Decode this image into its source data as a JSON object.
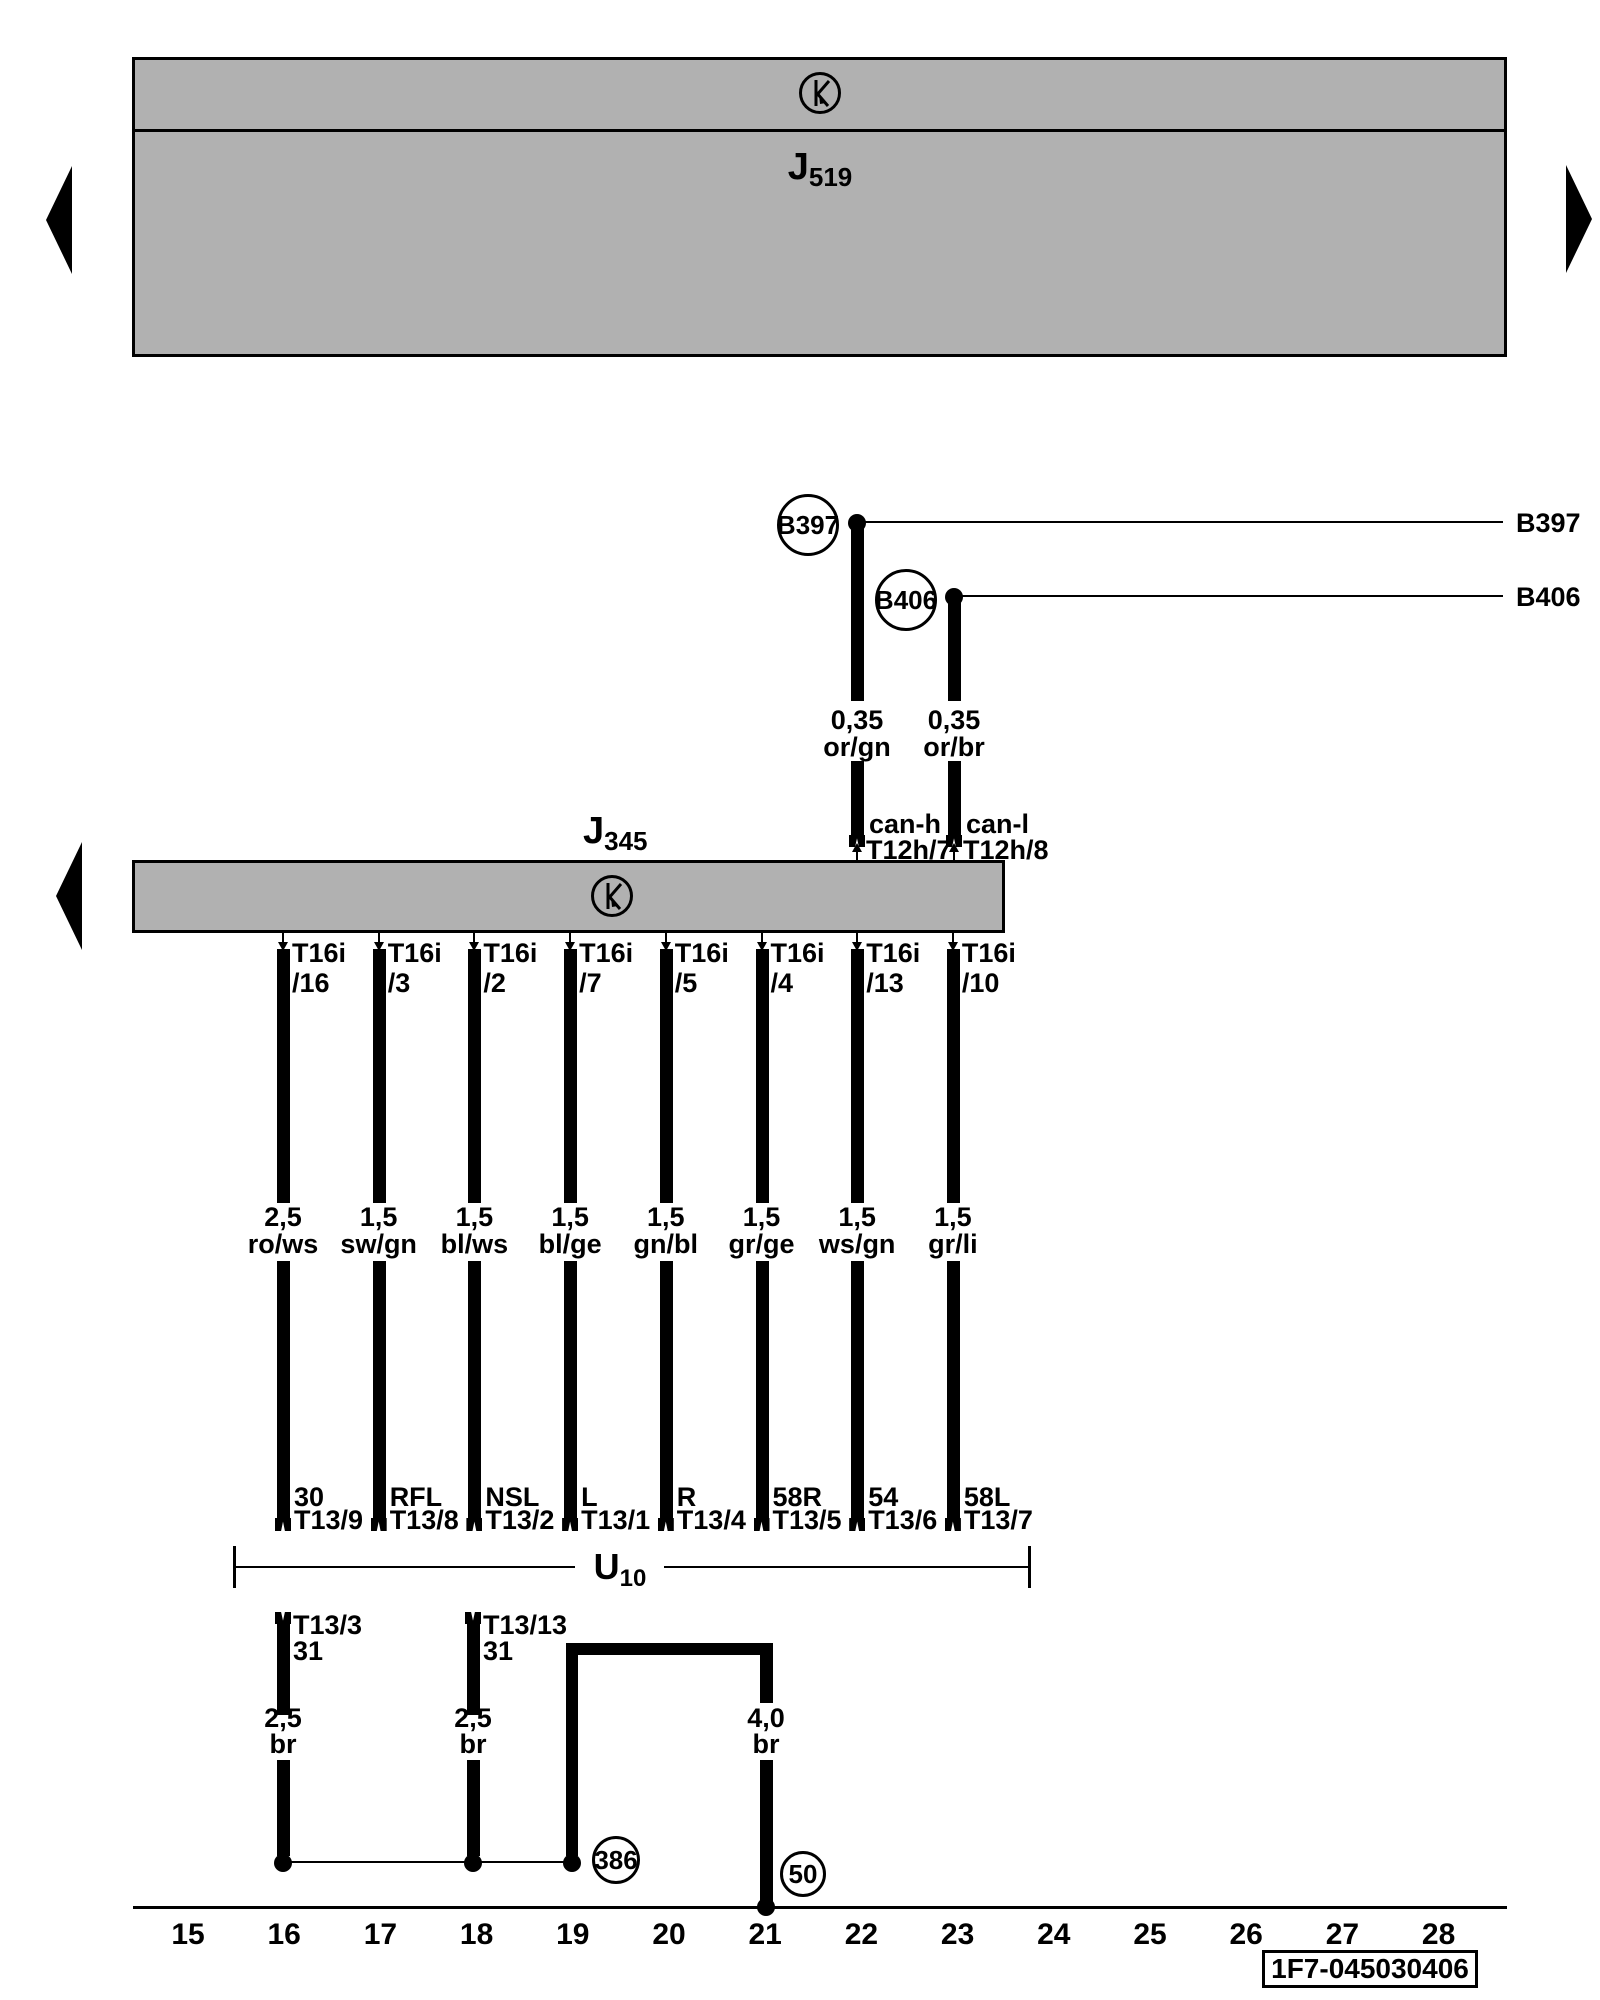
{
  "j519": {
    "main": "J",
    "sub": "519"
  },
  "j345": {
    "main": "J",
    "sub": "345"
  },
  "can_nodes": [
    {
      "id": "B397",
      "right_label": "B397",
      "gauge": "0,35",
      "color": "or/gn",
      "signal": "can-h",
      "pin": "T12h/7"
    },
    {
      "id": "B406",
      "right_label": "B406",
      "gauge": "0,35",
      "color": "or/br",
      "signal": "can-l",
      "pin": "T12h/8"
    }
  ],
  "pins": [
    {
      "connector": "T16i",
      "slot": "/16",
      "gauge": "2,5",
      "color": "ro/ws",
      "name": "30",
      "pin": "T13/9"
    },
    {
      "connector": "T16i",
      "slot": "/3",
      "gauge": "1,5",
      "color": "sw/gn",
      "name": "RFL",
      "pin": "T13/8"
    },
    {
      "connector": "T16i",
      "slot": "/2",
      "gauge": "1,5",
      "color": "bl/ws",
      "name": "NSL",
      "pin": "T13/2"
    },
    {
      "connector": "T16i",
      "slot": "/7",
      "gauge": "1,5",
      "color": "bl/ge",
      "name": "L",
      "pin": "T13/1"
    },
    {
      "connector": "T16i",
      "slot": "/5",
      "gauge": "1,5",
      "color": "gn/bl",
      "name": "R",
      "pin": "T13/4"
    },
    {
      "connector": "T16i",
      "slot": "/4",
      "gauge": "1,5",
      "color": "gr/ge",
      "name": "58R",
      "pin": "T13/5"
    },
    {
      "connector": "T16i",
      "slot": "/13",
      "gauge": "1,5",
      "color": "ws/gn",
      "name": "54",
      "pin": "T13/6"
    },
    {
      "connector": "T16i",
      "slot": "/10",
      "gauge": "1,5",
      "color": "gr/li",
      "name": "58L",
      "pin": "T13/7"
    }
  ],
  "u10": {
    "main": "U",
    "sub": "10"
  },
  "ground_pins": [
    {
      "pin": "T13/3",
      "terminal": "31",
      "gauge": "2,5",
      "color": "br"
    },
    {
      "pin": "T13/13",
      "terminal": "31",
      "gauge": "2,5",
      "color": "br"
    }
  ],
  "heavy_ground": {
    "gauge": "4,0",
    "color": "br"
  },
  "grounds": [
    {
      "id": "386"
    },
    {
      "id": "50"
    }
  ],
  "ruler": [
    "15",
    "16",
    "17",
    "18",
    "19",
    "20",
    "21",
    "22",
    "23",
    "24",
    "25",
    "26",
    "27",
    "28"
  ],
  "part_number": "1F7-045030406",
  "colors": {
    "box_fill": "#b1b1b1",
    "line": "#000000",
    "background": "#ffffff"
  }
}
